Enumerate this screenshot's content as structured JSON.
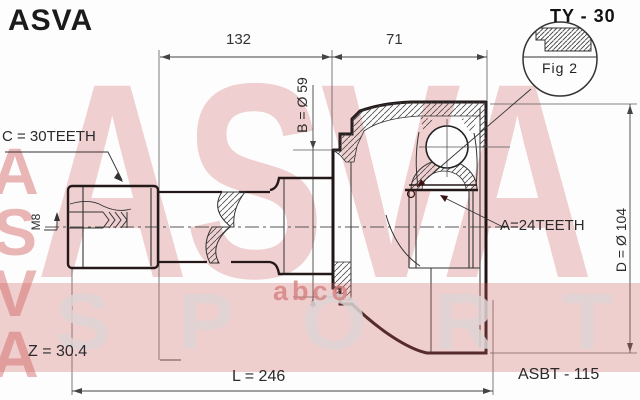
{
  "header": {
    "brand_logo": "ASVA",
    "part_code": "TY - 30"
  },
  "figure": {
    "callout": "Fig 2"
  },
  "dimensions": {
    "shaft_length": "132",
    "joint_width": "71",
    "boot_groove_diameter": "B = Ø 59",
    "outer_diameter": "D = Ø 104",
    "spline_length": "Z = 30.4",
    "total_length": "L = 246",
    "thread_size": "M8"
  },
  "teeth": {
    "outer_spline": "C = 30TEETH",
    "inner_spline": "A=24TEETH"
  },
  "boot_kit_code": "ASBT - 115",
  "watermark": {
    "brand": "ASVA",
    "sport": "SPORT",
    "side_brand": "ASVA",
    "small": "abco"
  },
  "colors": {
    "watermark_pink": "#efc6c6",
    "band_pink": "#eec6c6",
    "line": "#2a2020"
  }
}
